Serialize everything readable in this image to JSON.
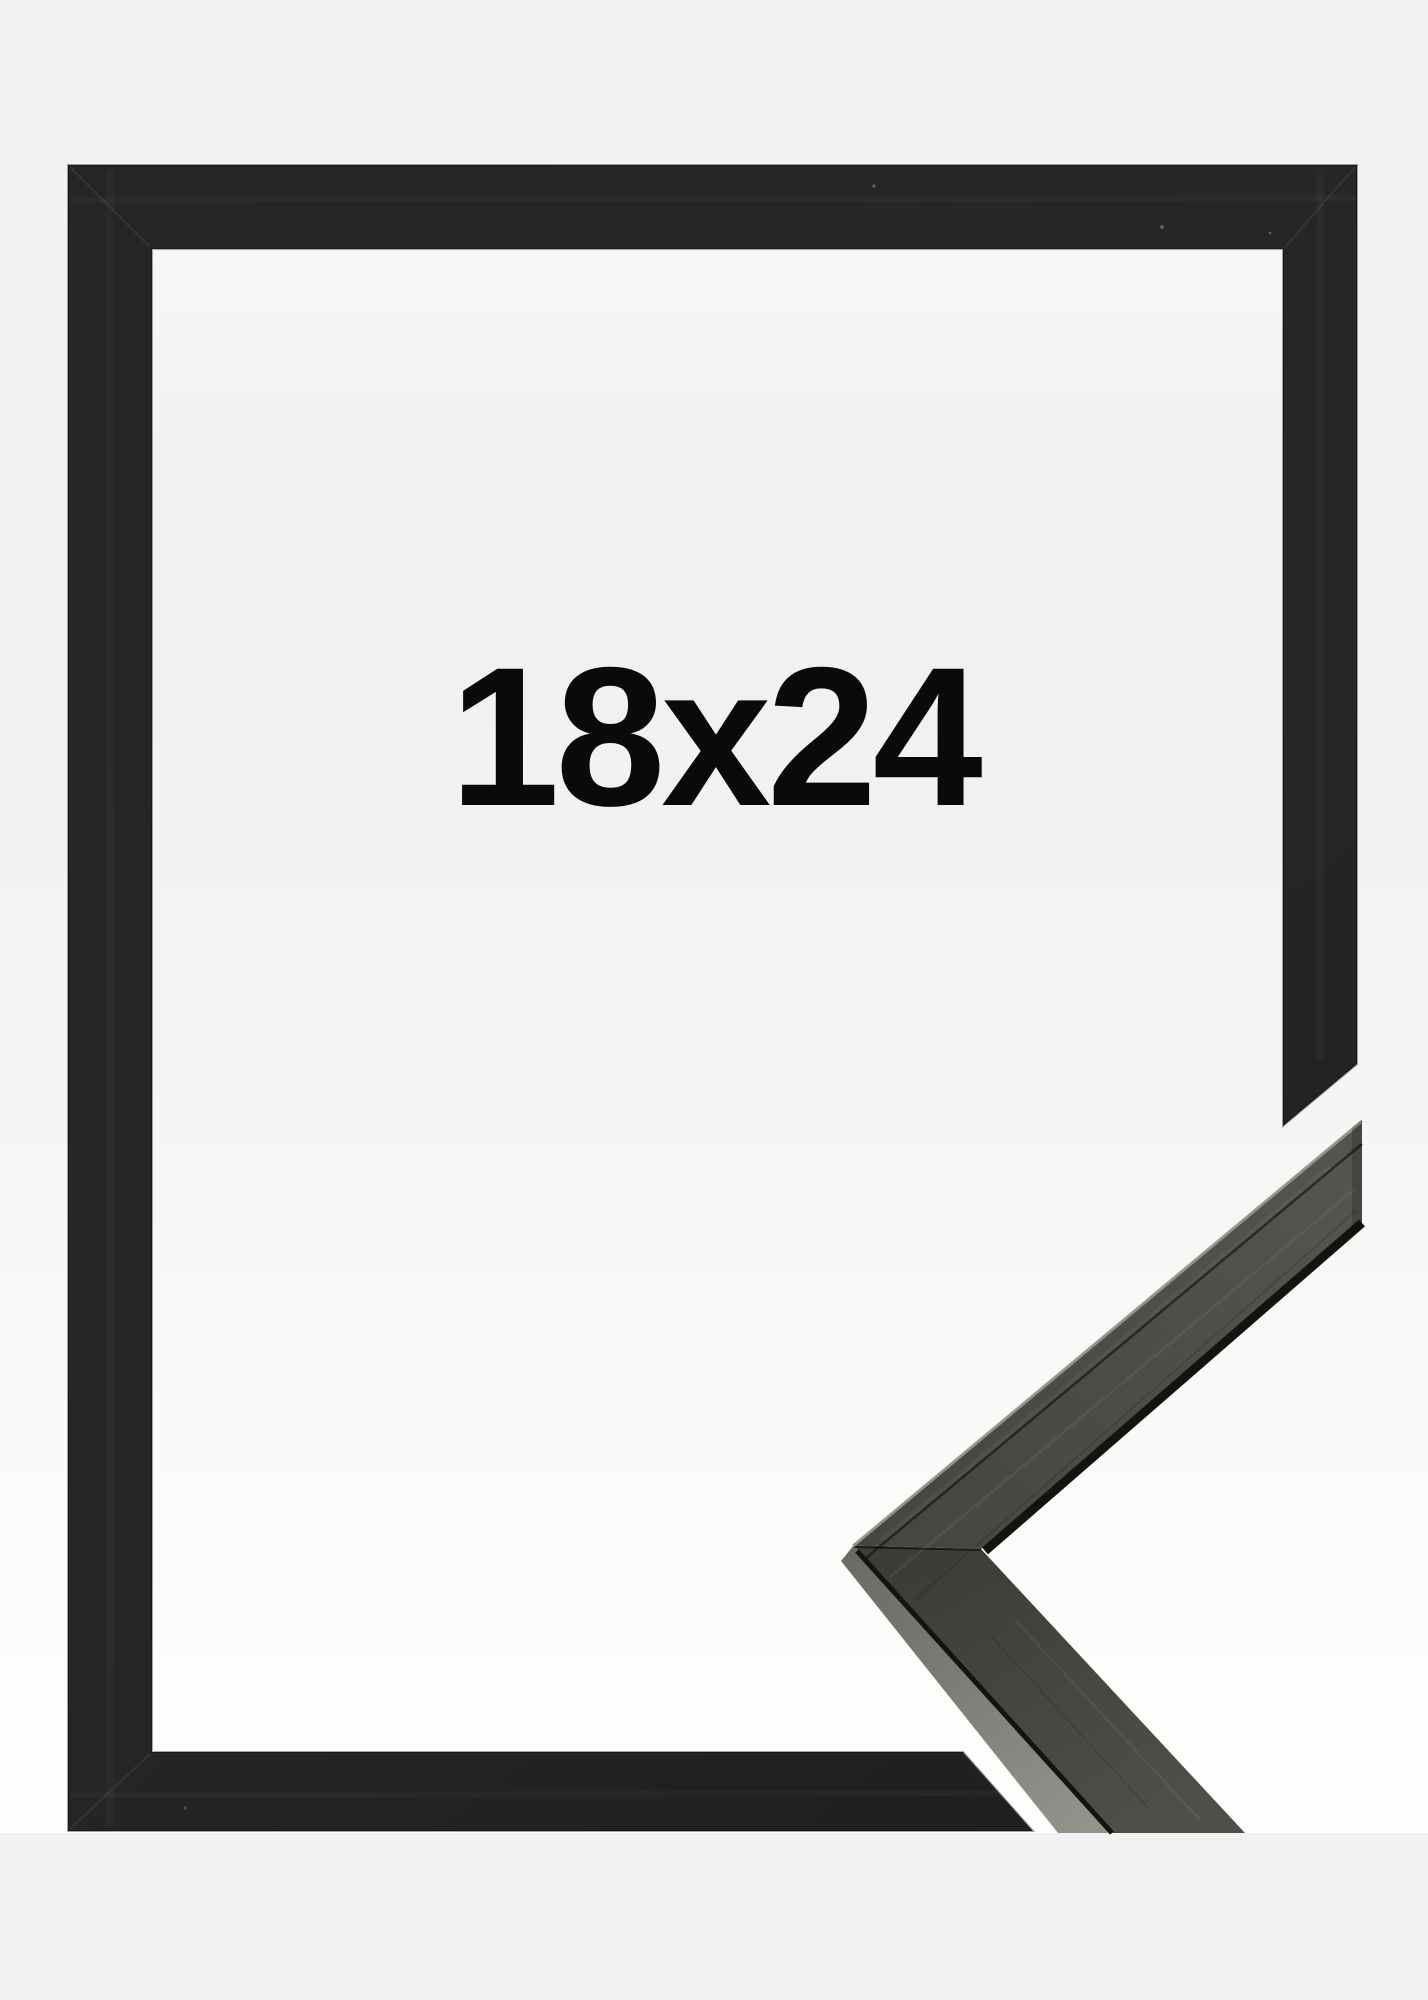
{
  "page": {
    "size_label": "18x24"
  },
  "colors": {
    "page-bg": "#f1f2f1",
    "photo-bg": "#fdfdfc",
    "frame-black": "#262524",
    "frame-black-dark": "#1e1d1c",
    "label-color": "#0a0a0a",
    "sample-front": "#4e4c48",
    "sample-front-dark": "#3d3c38",
    "sample-facet": "#93928b",
    "sample-edge": "#14130f",
    "sample-highlight": "#9b9a94"
  }
}
